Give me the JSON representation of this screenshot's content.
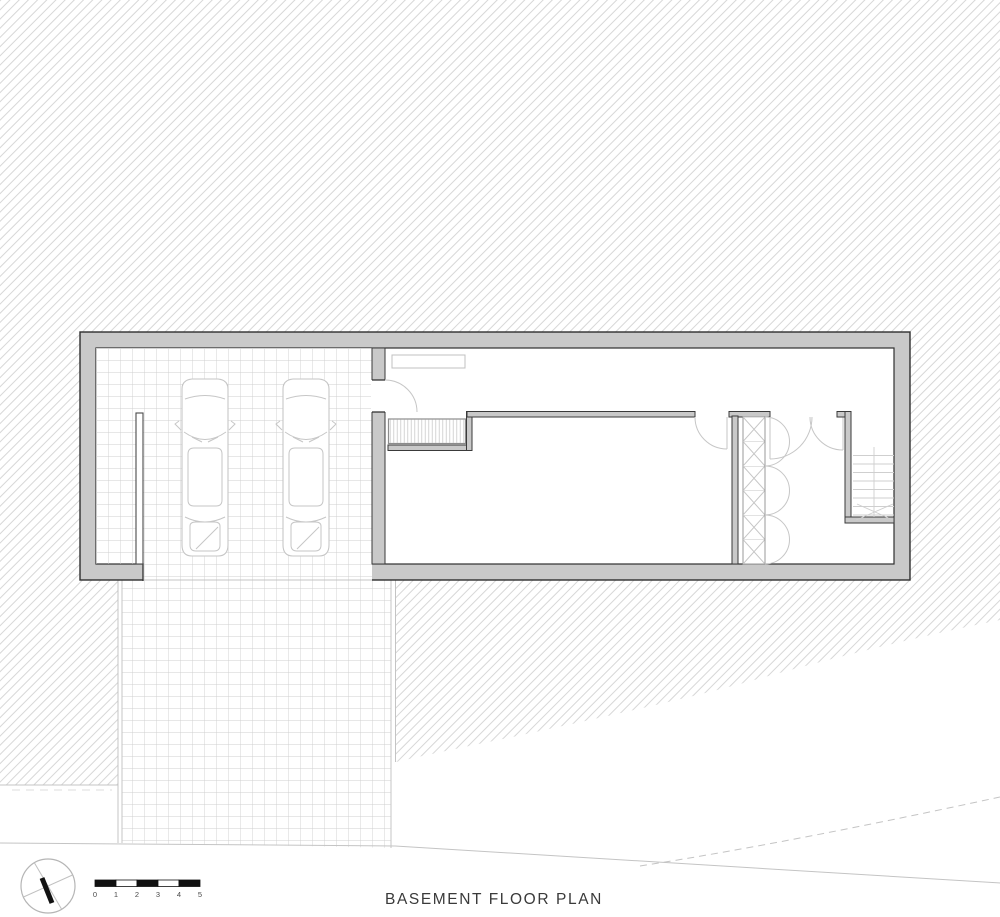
{
  "title": "BASEMENT FLOOR PLAN",
  "scale_bar": {
    "unit_labels": [
      "0",
      "1",
      "2",
      "3",
      "4",
      "5"
    ]
  },
  "north_arrow": {
    "icon": "north-arrow-icon"
  },
  "colors": {
    "wall_fill": "#c9c9c9",
    "wall_line": "#2f2f2f",
    "thin_wall_line": "#3a3a3a",
    "hatch_line": "#d7d7d7",
    "tile_line": "#cfcfcf",
    "symbol_line": "#c6c6c6",
    "stair_line": "#cfcfcf",
    "terrain_line": "#c4c4c4",
    "title_text": "#3a3a3a",
    "scale_text": "#4a4a4a",
    "scale_fill": "#111111"
  }
}
